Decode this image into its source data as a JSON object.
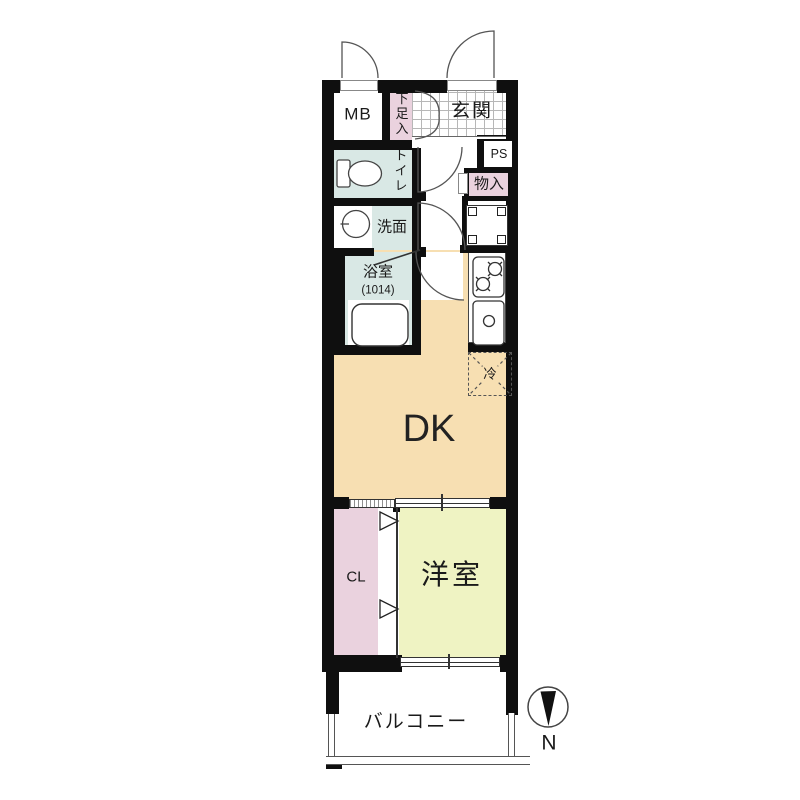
{
  "plan_title": "one-room apartment floor plan",
  "labels": {
    "meter_box": "MB",
    "shoe_box": "下足入",
    "entrance": "玄関",
    "pipe_space": "PS",
    "toilet": "トイレ",
    "storage": "物入",
    "washroom": "洗面",
    "bathroom": "浴室",
    "bathroom_size": "(1014)",
    "refrigerator": "冷",
    "dining_kitchen": "DK",
    "closet": "CL",
    "western_room": "洋室",
    "balcony": "バルコニー",
    "compass_north": "N"
  },
  "colors": {
    "wall": "#0f0f0f",
    "wet_area_blue": "#d9e8e5",
    "storage_pink": "#ead2de",
    "dining_kitchen_tan": "#f7dfb2",
    "western_room_green": "#eff3c3",
    "tile_line_gray": "#b7b7b7"
  }
}
